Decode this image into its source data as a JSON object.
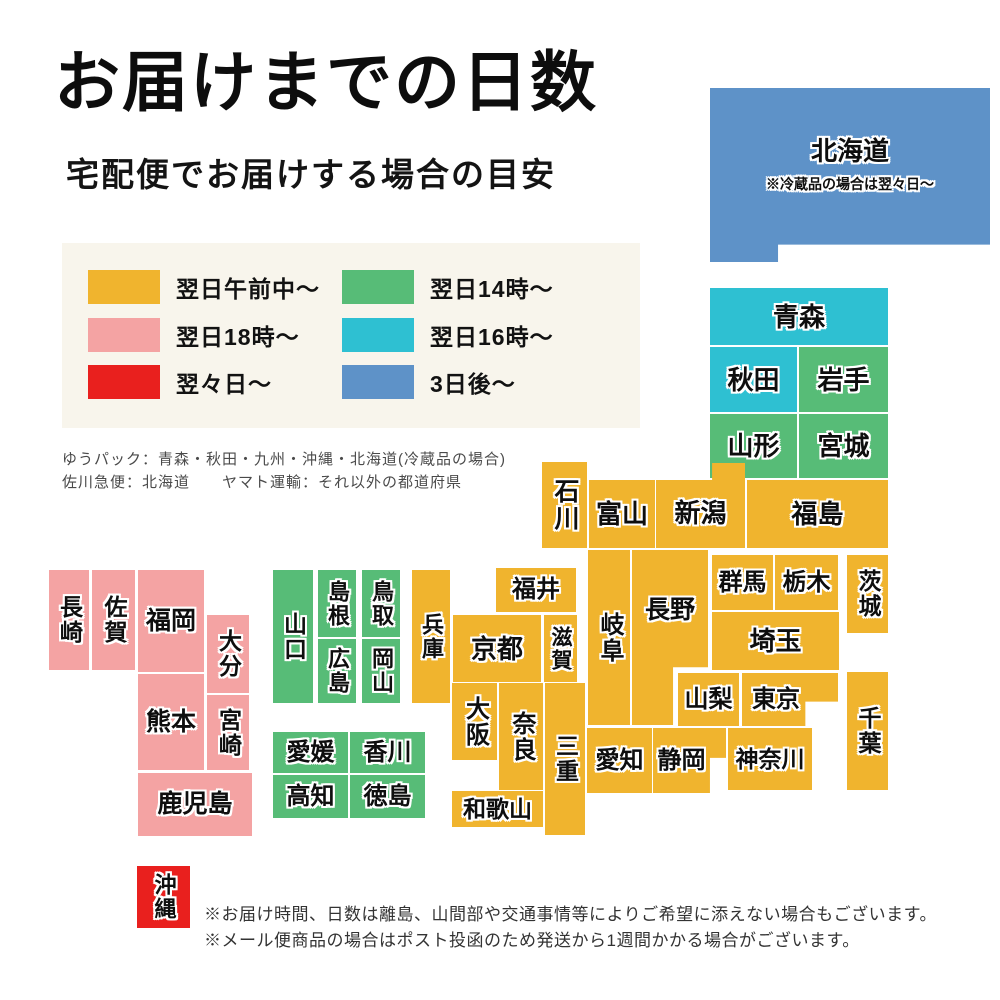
{
  "header": {
    "title": "お届けまでの日数",
    "subtitle": "宅配便でお届けする場合の目安"
  },
  "colors": {
    "gold": "#f0b42e",
    "pink": "#f4a3a3",
    "red": "#e9201e",
    "green": "#57bc77",
    "cyan": "#2ec0d2",
    "blue": "#5e92c8",
    "legend_bg": "#f8f5ec"
  },
  "legend": {
    "items": [
      {
        "color": "gold",
        "label": "翌日午前中〜"
      },
      {
        "color": "pink",
        "label": "翌日18時〜"
      },
      {
        "color": "red",
        "label": "翌々日〜"
      },
      {
        "color": "green",
        "label": "翌日14時〜"
      },
      {
        "color": "cyan",
        "label": "翌日16時〜"
      },
      {
        "color": "blue",
        "label": "3日後〜"
      }
    ]
  },
  "carriers": {
    "line1": "ゆうパック：青森・秋田・九州・沖縄・北海道(冷蔵品の場合)",
    "line2": "佐川急便：北海道　　ヤマト運輸：それ以外の都道府県"
  },
  "map": {
    "hokkaido_note": "※冷蔵品の場合は翌々日〜",
    "prefectures": [
      {
        "id": "hokkaido",
        "label": "北海道",
        "color": "blue"
      },
      {
        "id": "aomori",
        "label": "青森",
        "color": "cyan"
      },
      {
        "id": "akita",
        "label": "秋田",
        "color": "cyan"
      },
      {
        "id": "iwate",
        "label": "岩手",
        "color": "green"
      },
      {
        "id": "yamagata",
        "label": "山形",
        "color": "green"
      },
      {
        "id": "miyagi",
        "label": "宮城",
        "color": "green"
      },
      {
        "id": "ishikawa",
        "label": "石川",
        "color": "gold"
      },
      {
        "id": "toyama",
        "label": "富山",
        "color": "gold"
      },
      {
        "id": "niigata",
        "label": "新潟",
        "color": "gold"
      },
      {
        "id": "fukushima",
        "label": "福島",
        "color": "gold"
      },
      {
        "id": "gunma",
        "label": "群馬",
        "color": "gold"
      },
      {
        "id": "tochigi",
        "label": "栃木",
        "color": "gold"
      },
      {
        "id": "ibaraki",
        "label": "茨城",
        "color": "gold"
      },
      {
        "id": "saitama",
        "label": "埼玉",
        "color": "gold"
      },
      {
        "id": "yamanashi",
        "label": "山梨",
        "color": "gold"
      },
      {
        "id": "tokyo",
        "label": "東京",
        "color": "gold"
      },
      {
        "id": "chiba",
        "label": "千葉",
        "color": "gold"
      },
      {
        "id": "kanagawa",
        "label": "神奈川",
        "color": "gold"
      },
      {
        "id": "shizuoka",
        "label": "静岡",
        "color": "gold"
      },
      {
        "id": "aichi",
        "label": "愛知",
        "color": "gold"
      },
      {
        "id": "nagano",
        "label": "長野",
        "color": "gold"
      },
      {
        "id": "gifu",
        "label": "岐阜",
        "color": "gold"
      },
      {
        "id": "fukui",
        "label": "福井",
        "color": "gold"
      },
      {
        "id": "shiga",
        "label": "滋賀",
        "color": "gold"
      },
      {
        "id": "kyoto",
        "label": "京都",
        "color": "gold"
      },
      {
        "id": "osaka",
        "label": "大阪",
        "color": "gold"
      },
      {
        "id": "nara",
        "label": "奈良",
        "color": "gold"
      },
      {
        "id": "wakayama",
        "label": "和歌山",
        "color": "gold"
      },
      {
        "id": "mie",
        "label": "三重",
        "color": "gold"
      },
      {
        "id": "hyogo",
        "label": "兵庫",
        "color": "gold"
      },
      {
        "id": "yamaguchi",
        "label": "山口",
        "color": "green"
      },
      {
        "id": "shimane",
        "label": "島根",
        "color": "green"
      },
      {
        "id": "tottori",
        "label": "鳥取",
        "color": "green"
      },
      {
        "id": "hiroshima",
        "label": "広島",
        "color": "green"
      },
      {
        "id": "okayama",
        "label": "岡山",
        "color": "green"
      },
      {
        "id": "ehime",
        "label": "愛媛",
        "color": "green"
      },
      {
        "id": "kagawa",
        "label": "香川",
        "color": "green"
      },
      {
        "id": "kochi",
        "label": "高知",
        "color": "green"
      },
      {
        "id": "tokushima",
        "label": "徳島",
        "color": "green"
      },
      {
        "id": "nagasaki",
        "label": "長崎",
        "color": "pink"
      },
      {
        "id": "saga",
        "label": "佐賀",
        "color": "pink"
      },
      {
        "id": "fukuoka",
        "label": "福岡",
        "color": "pink"
      },
      {
        "id": "oita",
        "label": "大分",
        "color": "pink"
      },
      {
        "id": "kumamoto",
        "label": "熊本",
        "color": "pink"
      },
      {
        "id": "miyazaki",
        "label": "宮崎",
        "color": "pink"
      },
      {
        "id": "kagoshima",
        "label": "鹿児島",
        "color": "pink"
      },
      {
        "id": "okinawa",
        "label": "沖縄",
        "color": "red"
      }
    ]
  },
  "notes": [
    "※お届け時間、日数は離島、山間部や交通事情等によりご希望に添えない場合もございます。",
    "※メール便商品の場合はポスト投函のため発送から1週間かかる場合がございます。"
  ]
}
